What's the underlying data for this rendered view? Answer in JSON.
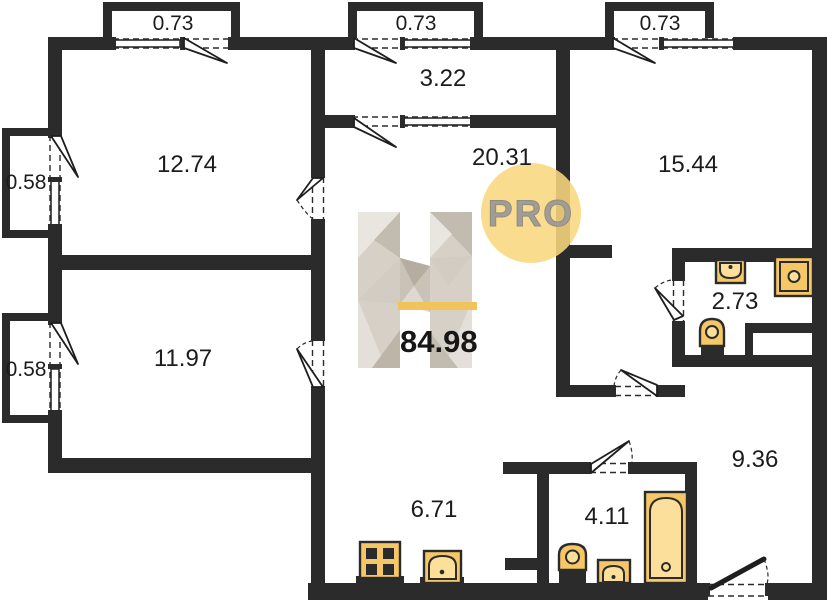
{
  "plan": {
    "title": "apartment-floor-plan",
    "total": {
      "area": "84.98"
    },
    "watermark": {
      "letter": "H",
      "badge": "PRO"
    },
    "rooms": [
      {
        "name": "bedroom-top-left",
        "area": "12.74"
      },
      {
        "name": "bedroom-bottom-left",
        "area": "11.97"
      },
      {
        "name": "balcony-vestibule",
        "area": "3.22"
      },
      {
        "name": "living-room",
        "area": "20.31"
      },
      {
        "name": "bedroom-right",
        "area": "15.44"
      },
      {
        "name": "wc",
        "area": "2.73"
      },
      {
        "name": "kitchen",
        "area": "6.71"
      },
      {
        "name": "bathroom",
        "area": "4.11"
      },
      {
        "name": "hallway",
        "area": "9.36"
      }
    ],
    "balconies": [
      {
        "name": "balcony-top-left",
        "area": "0.73"
      },
      {
        "name": "balcony-top-center",
        "area": "0.73"
      },
      {
        "name": "balcony-top-right",
        "area": "0.73"
      },
      {
        "name": "balcony-left-upper",
        "area": "0.58"
      },
      {
        "name": "balcony-left-lower",
        "area": "0.58"
      }
    ],
    "fixtures": [
      "stove-icon",
      "kitchen-sink-icon",
      "toilet-icon",
      "wash-basin-icon",
      "bathtub-icon",
      "washing-machine-icon"
    ],
    "colors": {
      "wall": "#2b2b2b",
      "fixture": "#f6c766",
      "fixture_inner": "#fbdf9a",
      "accent_circle": "#f9d77e",
      "accent_bar": "#f0c45c",
      "label": "#1c1c1c",
      "logo_text": "#a19d94"
    }
  }
}
